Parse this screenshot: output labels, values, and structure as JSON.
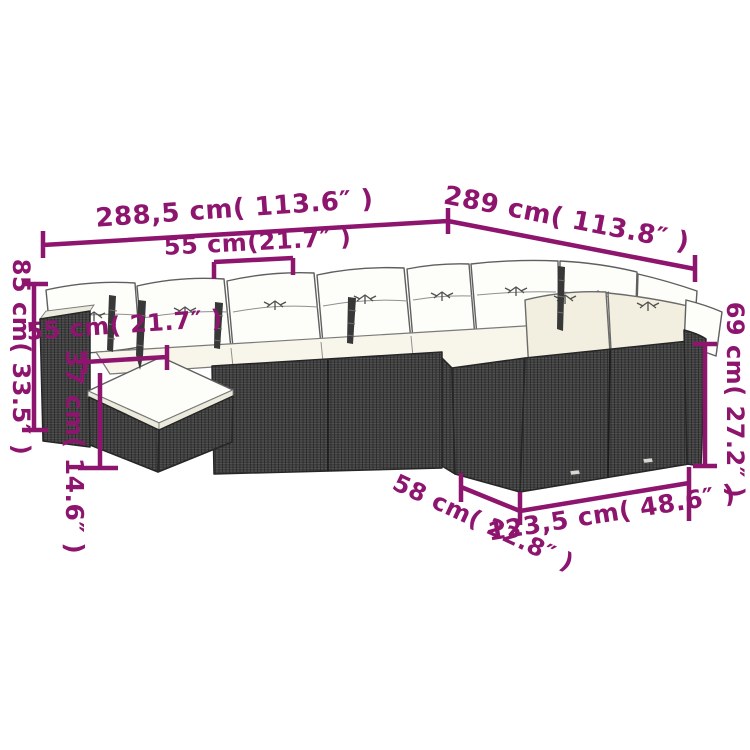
{
  "diagram": {
    "type": "product-dimension-diagram",
    "subject": "rattan corner garden sofa set with cushions and footstool",
    "accent_color": "#8d156e",
    "background_color": "#ffffff",
    "wicker_color": "#3d3d3d",
    "cushion_color": "#fdfdf9",
    "labels": {
      "back_width_left": "288,5 cm( 113.6″ )",
      "back_width_right": "289 cm( 113.8″ )",
      "seat_width": "55 cm(21.7″ )",
      "overall_height": "85 cm( 33.5″ )",
      "footstool_width": "55 cm( 21.7″ )",
      "footstool_height": "37 cm( 14.6″ )",
      "backrest_height": "69 cm( 27.2″ )",
      "seat_depth": "58 cm( 22.8″ )",
      "right_module_length": "123,5 cm( 48.6″ )"
    }
  }
}
